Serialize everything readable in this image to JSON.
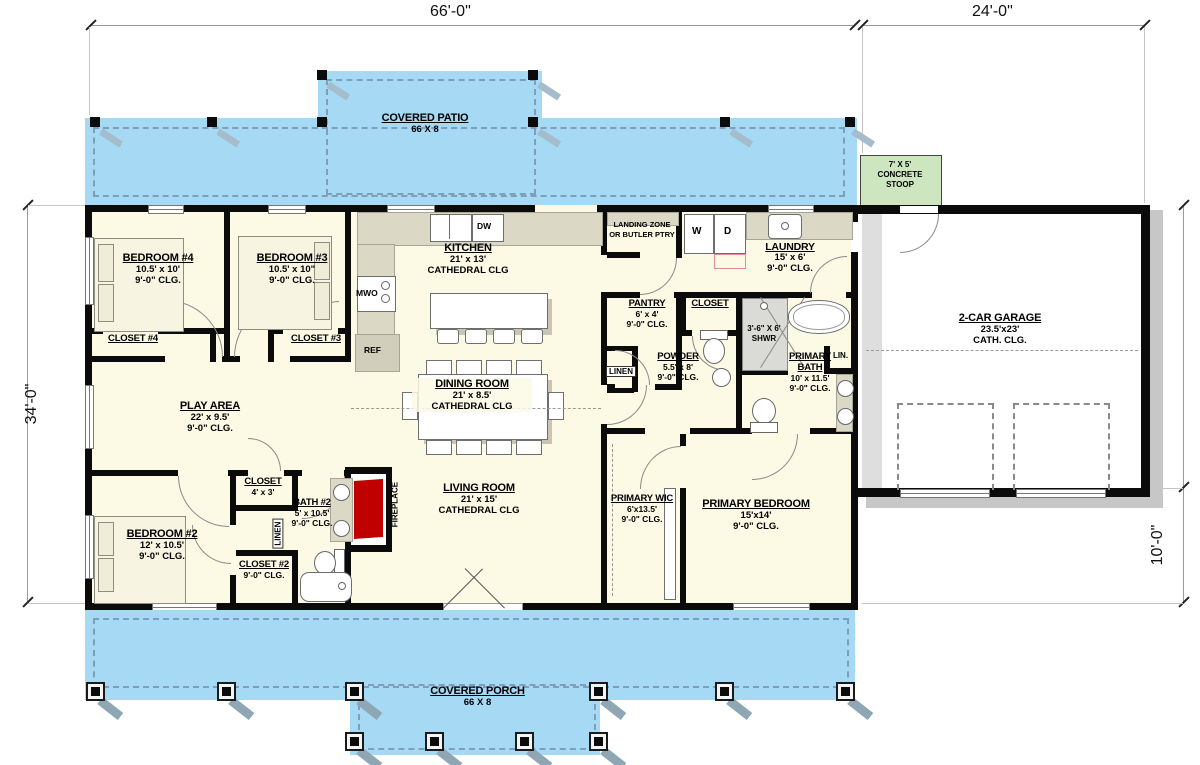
{
  "dimensions": {
    "top_width": "66'-0\"",
    "garage_width": "24'-0\"",
    "left_height": "34'-0\"",
    "garage_height": "24'-0\"",
    "right_depth": "10'-0\""
  },
  "outdoor": {
    "patio": {
      "name": "COVERED PATIO",
      "size": "66 X 8"
    },
    "stoop": {
      "l1": "7' X 5'",
      "l2": "CONCRETE",
      "l3": "STOOP"
    },
    "porch": {
      "name": "COVERED PORCH",
      "size": "66 X 8"
    }
  },
  "rooms": {
    "bedroom4": {
      "name": "BEDROOM #4",
      "dims": "10.5' x 10'",
      "clg": "9'-0\" CLG."
    },
    "bedroom3": {
      "name": "BEDROOM #3",
      "dims": "10.5' x 10\"",
      "clg": "9'-0\" CLG."
    },
    "closet4": {
      "name": "CLOSET #4"
    },
    "closet3": {
      "name": "CLOSET #3"
    },
    "kitchen": {
      "name": "KITCHEN",
      "dims": "21' x 13'",
      "clg": "CATHEDRAL CLG"
    },
    "landing_zone": {
      "l1": "LANDING ZONE",
      "l2": "OR BUTLER PTRY"
    },
    "laundry": {
      "name": "LAUNDRY",
      "dims": "15' x 6'",
      "clg": "9'-0\" CLG."
    },
    "pantry": {
      "name": "PANTRY",
      "dims": "6' x 4'",
      "clg": "9'-0\" CLG."
    },
    "hall_closet": {
      "name": "CLOSET"
    },
    "shower": {
      "l1": "3'-6\" X 6'",
      "l2": "SHWR"
    },
    "powder": {
      "name": "POWDER",
      "dims": "5.5' x 8'",
      "clg": "9'-0\" CLG."
    },
    "linen": {
      "name": "LINEN"
    },
    "primary_bath": {
      "l1": "PRIMARY",
      "l2": "BATH",
      "dims": "10' x 11.5'",
      "clg": "9'-0\" CLG."
    },
    "lin_closet": {
      "name": "LIN."
    },
    "garage": {
      "name": "2-CAR GARAGE",
      "dims": "23.5'x23'",
      "clg": "CATH. CLG."
    },
    "play_area": {
      "name": "PLAY AREA",
      "dims": "22' x 9.5'",
      "clg": "9'-0\" CLG."
    },
    "dining": {
      "name": "DINING ROOM",
      "dims": "21' x 8.5'",
      "clg": "CATHEDRAL CLG"
    },
    "living": {
      "name": "LIVING ROOM",
      "dims": "21' x 15'",
      "clg": "CATHEDRAL CLG"
    },
    "fireplace": {
      "name": "FIREPLACE"
    },
    "closet_4x3": {
      "name": "CLOSET",
      "dims": "4' x 3'"
    },
    "bath2": {
      "name": "BATH #2",
      "dims": "5' x 10.5'",
      "clg": "9'-0\" CLG."
    },
    "linen2": {
      "name": "LINEN"
    },
    "bedroom2": {
      "name": "BEDROOM #2",
      "dims": "12' x 10.5'",
      "clg": "9'-0\" CLG."
    },
    "closet2": {
      "name": "CLOSET #2",
      "clg": "9'-0\" CLG."
    },
    "primary_wic": {
      "name": "PRIMARY WIC",
      "dims": "6'x13.5'",
      "clg": "9'-0\" CLG."
    },
    "primary_bedroom": {
      "name": "PRIMARY BEDROOM",
      "dims": "15'x14'",
      "clg": "9'-0\" CLG."
    }
  },
  "appliances": {
    "dw": "DW",
    "mwo": "MWO",
    "ref": "REF",
    "washer": "W",
    "dryer": "D"
  },
  "colors": {
    "patio_blue": "#A6D9F4",
    "stoop_green": "#CDE6BF",
    "interior_cream": "#FCF9E4",
    "wall_black": "#0B0B0B",
    "fireplace_red": "#C00000",
    "shadow_gray": "#C7C7C7"
  }
}
